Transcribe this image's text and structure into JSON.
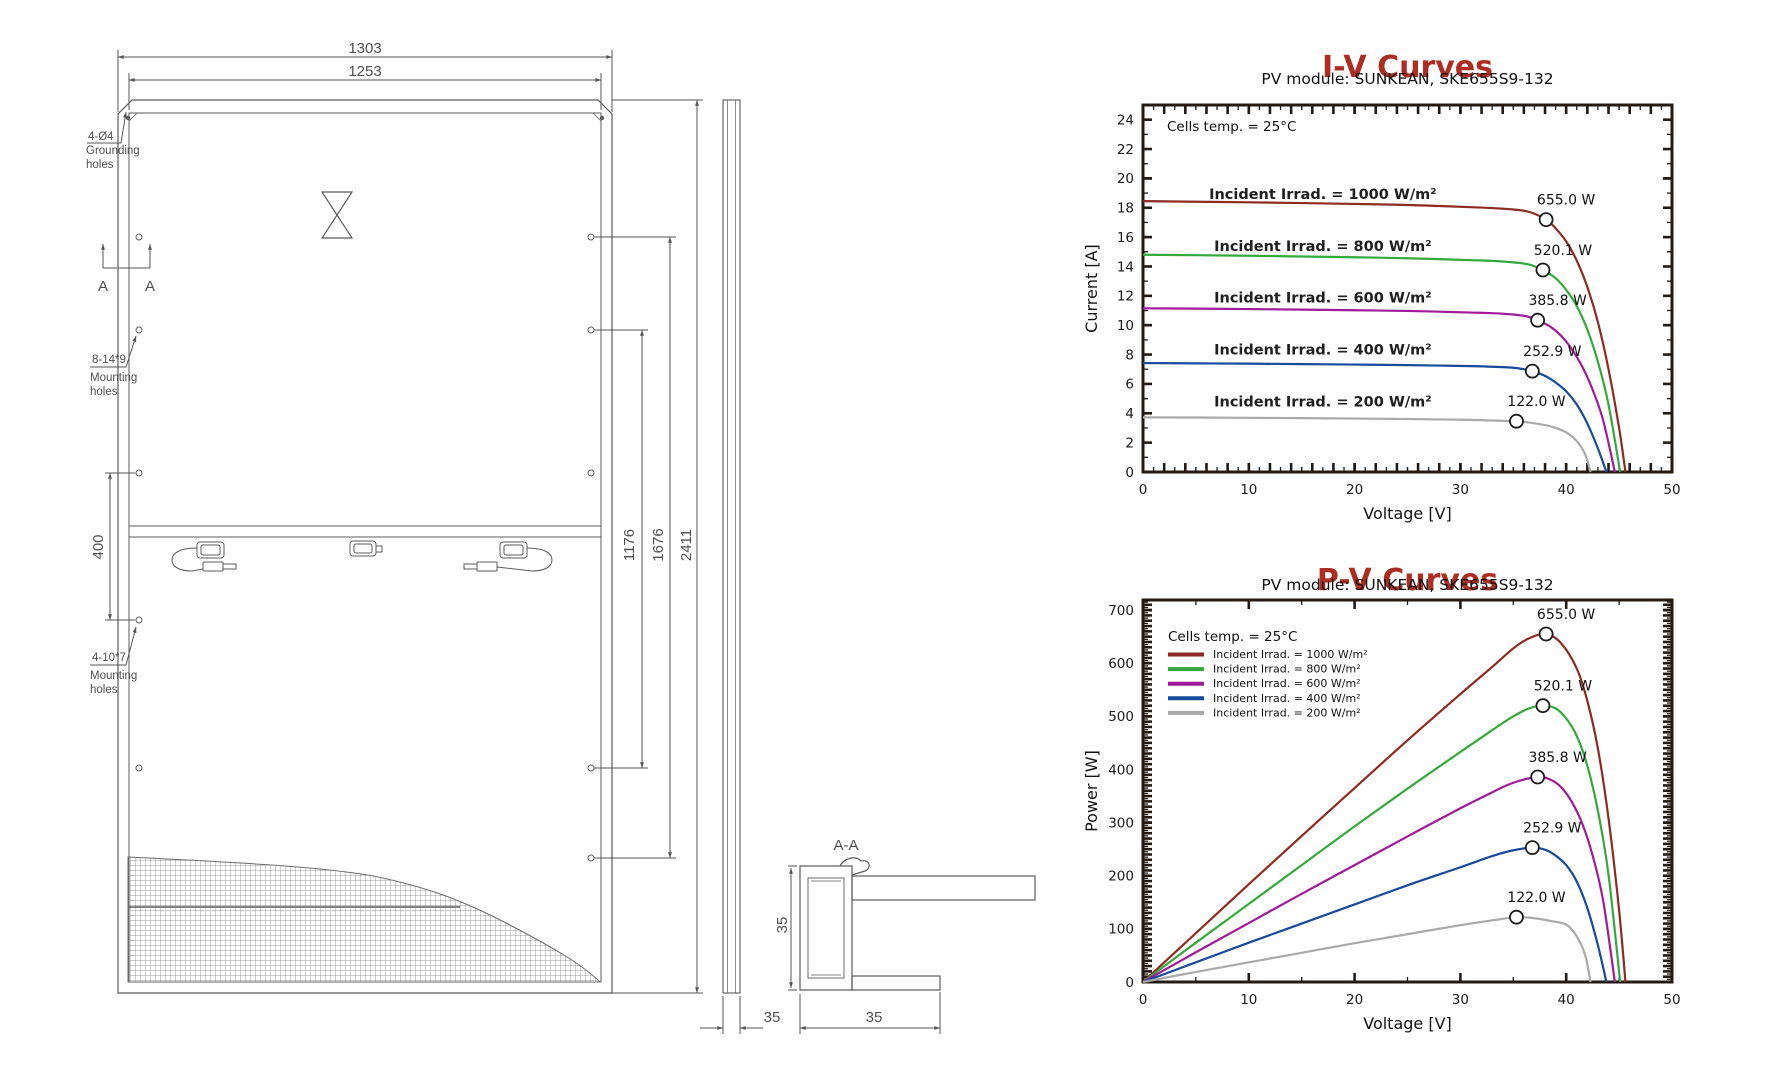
{
  "drawing": {
    "dims": {
      "width_outer": "1303",
      "width_inner": "1253",
      "hole_span": "400",
      "v_hole_span1": "1176",
      "v_hole_span2": "1676",
      "height": "2411",
      "side_thickness": "35",
      "section_height": "35",
      "section_width": "35"
    },
    "labels": {
      "grounding": [
        "4-Ø4",
        "Grounding",
        "holes"
      ],
      "mounting8": [
        "8-14*9",
        "Mounting",
        "holes"
      ],
      "mounting4": [
        "4-10*7",
        "Mounting",
        "holes"
      ],
      "section_marker_1": "A",
      "section_marker_2": "A",
      "section_title": "A-A"
    }
  },
  "theme": {
    "title_color": "#ad2d22",
    "spine_color": "#241a14",
    "drawing_line_color": "#5b5b5b"
  },
  "chart_data": [
    {
      "id": "iv",
      "type": "line",
      "title": "I-V Curves",
      "subtitle": "PV module: SUNKEAN, SKE655S9-132",
      "xlabel": "Voltage [V]",
      "ylabel": "Current [A]",
      "annotation": "Cells temp. = 25°C",
      "xlim": [
        0,
        50
      ],
      "ylim": [
        0,
        25
      ],
      "xticks": {
        "major": 10,
        "minor": 5
      },
      "yticks": {
        "major": 2,
        "minor": 1,
        "max_label": 24
      },
      "legend": false,
      "series": [
        {
          "id": "irr-1000",
          "name": "Incident Irrad. = 1000 W/m²",
          "color": "#8f2a20",
          "label_anchor": [
            17,
            18.6
          ],
          "mpp": {
            "x": 38.1,
            "y": 17.19,
            "label": "655.0 W"
          },
          "points": [
            [
              0,
              18.45
            ],
            [
              5,
              18.41
            ],
            [
              10,
              18.37
            ],
            [
              15,
              18.32
            ],
            [
              20,
              18.26
            ],
            [
              25,
              18.19
            ],
            [
              28,
              18.12
            ],
            [
              31,
              18.04
            ],
            [
              33,
              17.98
            ],
            [
              35,
              17.88
            ],
            [
              36.5,
              17.72
            ],
            [
              38.1,
              17.19
            ],
            [
              39,
              16.6
            ],
            [
              40,
              15.7
            ],
            [
              41,
              14.4
            ],
            [
              42,
              12.6
            ],
            [
              43,
              10.2
            ],
            [
              44,
              7.0
            ],
            [
              45,
              3.0
            ],
            [
              45.6,
              0
            ]
          ]
        },
        {
          "id": "irr-800",
          "name": "Incident Irrad. = 800 W/m²",
          "color": "#33a93c",
          "label_anchor": [
            17,
            15.05
          ],
          "mpp": {
            "x": 37.8,
            "y": 13.76,
            "label": "520.1 W"
          },
          "points": [
            [
              0,
              14.8
            ],
            [
              5,
              14.77
            ],
            [
              10,
              14.73
            ],
            [
              15,
              14.68
            ],
            [
              20,
              14.63
            ],
            [
              25,
              14.56
            ],
            [
              28,
              14.5
            ],
            [
              31,
              14.43
            ],
            [
              33,
              14.38
            ],
            [
              35,
              14.28
            ],
            [
              36.5,
              14.13
            ],
            [
              37.8,
              13.76
            ],
            [
              39,
              13.2
            ],
            [
              40,
              12.4
            ],
            [
              41,
              11.3
            ],
            [
              42,
              9.7
            ],
            [
              43,
              7.5
            ],
            [
              44,
              4.6
            ],
            [
              45.1,
              0
            ]
          ]
        },
        {
          "id": "irr-600",
          "name": "Incident Irrad. = 600 W/m²",
          "color": "#a01a99",
          "label_anchor": [
            17,
            11.55
          ],
          "mpp": {
            "x": 37.3,
            "y": 10.34,
            "label": "385.8 W"
          },
          "points": [
            [
              0,
              11.15
            ],
            [
              5,
              11.13
            ],
            [
              10,
              11.1
            ],
            [
              15,
              11.06
            ],
            [
              20,
              11.02
            ],
            [
              25,
              10.97
            ],
            [
              28,
              10.92
            ],
            [
              31,
              10.86
            ],
            [
              33,
              10.82
            ],
            [
              35,
              10.73
            ],
            [
              36.3,
              10.6
            ],
            [
              37.3,
              10.34
            ],
            [
              38.5,
              9.9
            ],
            [
              39.5,
              9.3
            ],
            [
              40.5,
              8.4
            ],
            [
              41.5,
              7.2
            ],
            [
              42.5,
              5.6
            ],
            [
              43.5,
              3.5
            ],
            [
              44.6,
              0
            ]
          ]
        },
        {
          "id": "irr-400",
          "name": "Incident Irrad. = 400 W/m²",
          "color": "#17499c",
          "label_anchor": [
            17,
            8.0
          ],
          "mpp": {
            "x": 36.8,
            "y": 6.87,
            "label": "252.9 W"
          },
          "points": [
            [
              0,
              7.42
            ],
            [
              5,
              7.4
            ],
            [
              10,
              7.38
            ],
            [
              15,
              7.35
            ],
            [
              20,
              7.32
            ],
            [
              25,
              7.28
            ],
            [
              28,
              7.25
            ],
            [
              31,
              7.21
            ],
            [
              33,
              7.17
            ],
            [
              35,
              7.1
            ],
            [
              36,
              7.0
            ],
            [
              36.8,
              6.87
            ],
            [
              38,
              6.55
            ],
            [
              39,
              6.1
            ],
            [
              40,
              5.5
            ],
            [
              41,
              4.6
            ],
            [
              42,
              3.3
            ],
            [
              43,
              1.6
            ],
            [
              43.8,
              0
            ]
          ]
        },
        {
          "id": "irr-200",
          "name": "Incident Irrad. = 200 W/m²",
          "color": "#a9a9a9",
          "label_anchor": [
            17,
            4.45
          ],
          "mpp": {
            "x": 35.3,
            "y": 3.46,
            "label": "122.0 W"
          },
          "points": [
            [
              0,
              3.72
            ],
            [
              5,
              3.71
            ],
            [
              10,
              3.69
            ],
            [
              15,
              3.67
            ],
            [
              20,
              3.64
            ],
            [
              25,
              3.61
            ],
            [
              28,
              3.58
            ],
            [
              31,
              3.55
            ],
            [
              33,
              3.51
            ],
            [
              34.5,
              3.48
            ],
            [
              35.3,
              3.46
            ],
            [
              36.5,
              3.37
            ],
            [
              38,
              3.2
            ],
            [
              39,
              3.0
            ],
            [
              40,
              2.7
            ],
            [
              41,
              2.1
            ],
            [
              41.8,
              1.2
            ],
            [
              42.3,
              0
            ]
          ]
        }
      ]
    },
    {
      "id": "pv",
      "type": "line",
      "title": "P-V Curves",
      "subtitle": "PV module: SUNKEAN, SKE655S9-132",
      "xlabel": "Voltage [V]",
      "ylabel": "Power [W]",
      "annotation": "Cells temp. = 25°C",
      "xlim": [
        0,
        50
      ],
      "ylim": [
        0,
        719
      ],
      "xticks": {
        "major": 10,
        "minor": 5
      },
      "yticks": {
        "major": 100,
        "minor": 50,
        "max_label": 700
      },
      "legend": true,
      "series": [
        {
          "id": "irr-1000",
          "name": "Incident Irrad. = 1000 W/m²",
          "color": "#8f2a20",
          "mpp": {
            "x": 38.1,
            "y": 655.0,
            "label": "655.0 W"
          },
          "points": [
            [
              0,
              0
            ],
            [
              5,
              92
            ],
            [
              10,
              184
            ],
            [
              15,
              275
            ],
            [
              20,
              365
            ],
            [
              25,
              455
            ],
            [
              30,
              542
            ],
            [
              33,
              593
            ],
            [
              35,
              628
            ],
            [
              36.5,
              647
            ],
            [
              38.1,
              655
            ],
            [
              39.5,
              638
            ],
            [
              41,
              590
            ],
            [
              42,
              529
            ],
            [
              43,
              439
            ],
            [
              44,
              308
            ],
            [
              45,
              135
            ],
            [
              45.6,
              0
            ]
          ]
        },
        {
          "id": "irr-800",
          "name": "Incident Irrad. = 800 W/m²",
          "color": "#33a93c",
          "mpp": {
            "x": 37.8,
            "y": 520.1,
            "label": "520.1 W"
          },
          "points": [
            [
              0,
              0
            ],
            [
              5,
              74
            ],
            [
              10,
              147
            ],
            [
              15,
              220
            ],
            [
              20,
              293
            ],
            [
              25,
              364
            ],
            [
              30,
              433
            ],
            [
              33,
              474
            ],
            [
              35,
              500
            ],
            [
              36.5,
              515
            ],
            [
              37.8,
              520.1
            ],
            [
              39,
              515
            ],
            [
              40,
              496
            ],
            [
              41,
              463
            ],
            [
              42,
              407
            ],
            [
              43,
              322
            ],
            [
              44,
              202
            ],
            [
              45.1,
              0
            ]
          ]
        },
        {
          "id": "irr-600",
          "name": "Incident Irrad. = 600 W/m²",
          "color": "#a01a99",
          "mpp": {
            "x": 37.3,
            "y": 385.8,
            "label": "385.8 W"
          },
          "points": [
            [
              0,
              0
            ],
            [
              5,
              56
            ],
            [
              10,
              111
            ],
            [
              15,
              166
            ],
            [
              20,
              220
            ],
            [
              25,
              274
            ],
            [
              30,
              327
            ],
            [
              33,
              357
            ],
            [
              35,
              375
            ],
            [
              37.3,
              385.8
            ],
            [
              38.5,
              381
            ],
            [
              39.5,
              367
            ],
            [
              40.5,
              340
            ],
            [
              41.5,
              299
            ],
            [
              42.5,
              238
            ],
            [
              43.5,
              152
            ],
            [
              44.6,
              0
            ]
          ]
        },
        {
          "id": "irr-400",
          "name": "Incident Irrad. = 400 W/m²",
          "color": "#17499c",
          "mpp": {
            "x": 36.8,
            "y": 252.9,
            "label": "252.9 W"
          },
          "points": [
            [
              0,
              0
            ],
            [
              5,
              37
            ],
            [
              10,
              74
            ],
            [
              15,
              110
            ],
            [
              20,
              146
            ],
            [
              25,
              182
            ],
            [
              30,
              216
            ],
            [
              33,
              237
            ],
            [
              35,
              248
            ],
            [
              36.8,
              252.9
            ],
            [
              38,
              249
            ],
            [
              39,
              238
            ],
            [
              40,
              220
            ],
            [
              41,
              189
            ],
            [
              42,
              139
            ],
            [
              43,
              69
            ],
            [
              43.8,
              0
            ]
          ]
        },
        {
          "id": "irr-200",
          "name": "Incident Irrad. = 200 W/m²",
          "color": "#a9a9a9",
          "mpp": {
            "x": 35.3,
            "y": 122.0,
            "label": "122.0 W"
          },
          "points": [
            [
              0,
              0
            ],
            [
              5,
              19
            ],
            [
              10,
              37
            ],
            [
              15,
              55
            ],
            [
              20,
              73
            ],
            [
              25,
              90
            ],
            [
              30,
              107
            ],
            [
              33,
              116
            ],
            [
              35.3,
              122
            ],
            [
              37,
              120
            ],
            [
              38.5,
              115
            ],
            [
              40,
              108
            ],
            [
              41,
              86
            ],
            [
              41.8,
              50
            ],
            [
              42.3,
              0
            ]
          ]
        }
      ]
    }
  ]
}
